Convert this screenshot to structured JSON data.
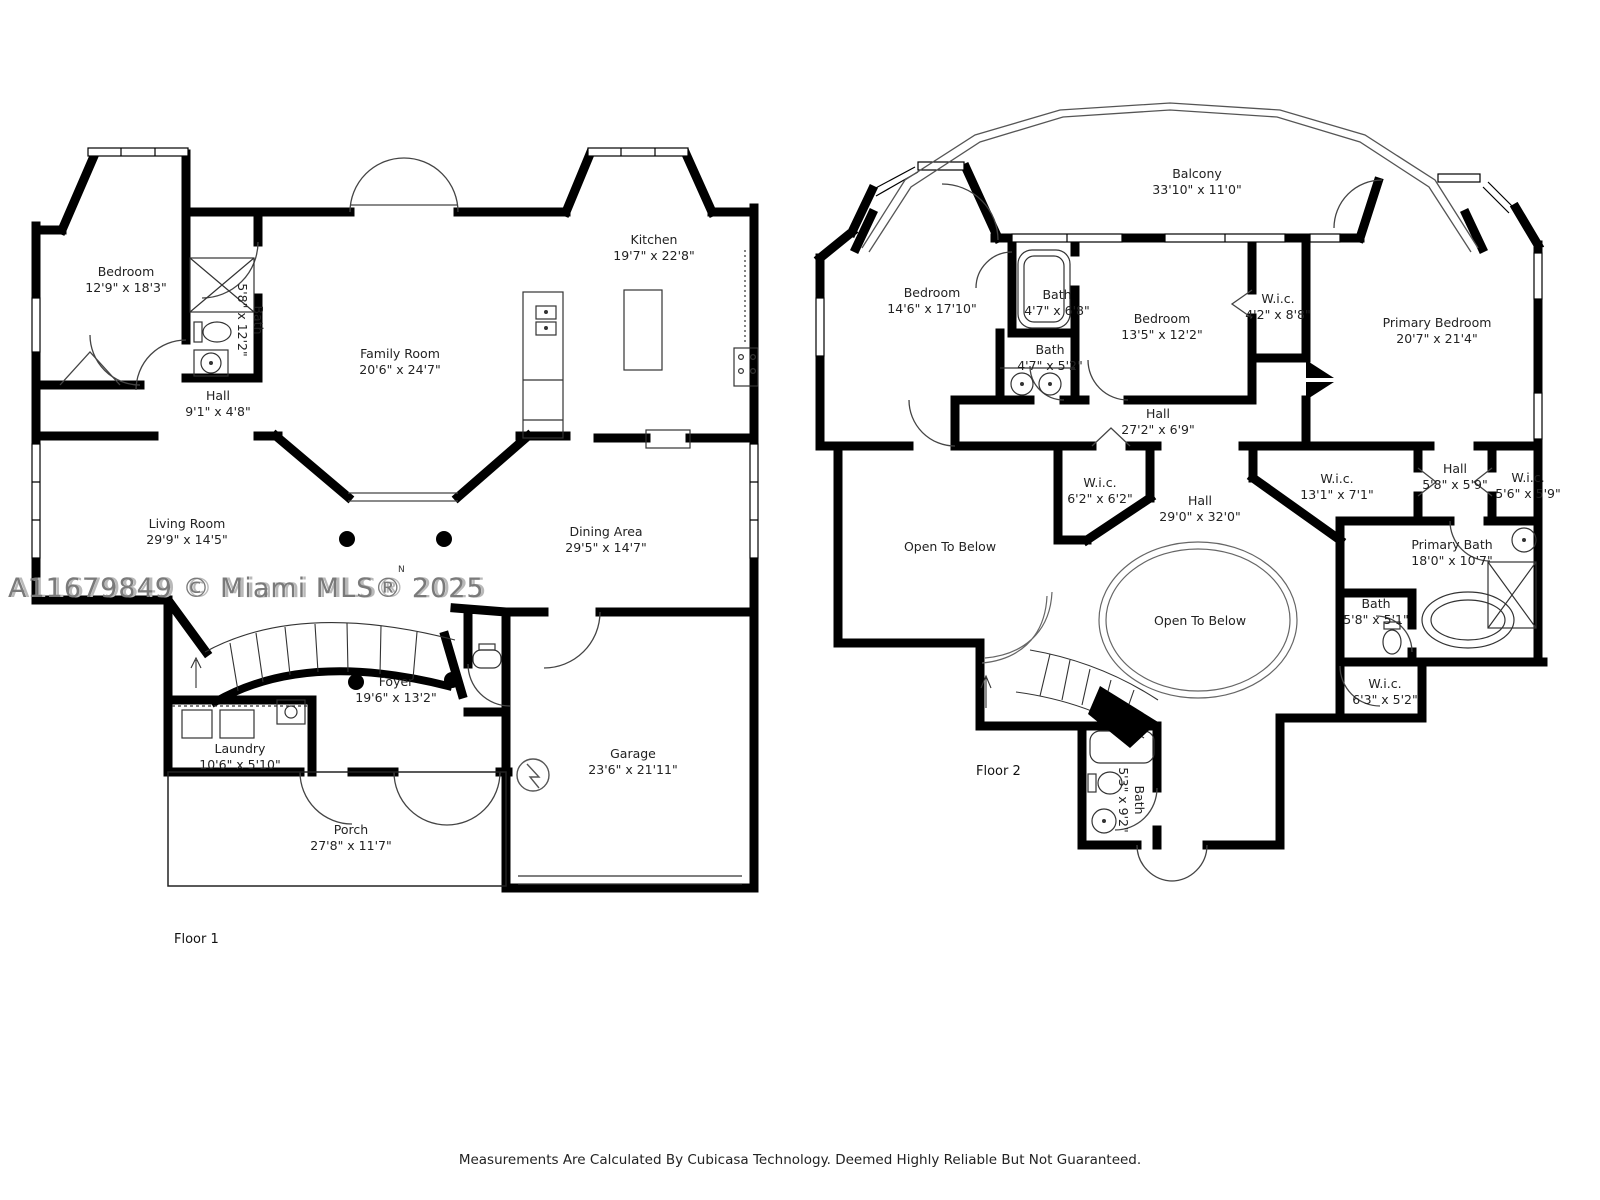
{
  "watermark": {
    "text": "A11679849 © Miami MLS® 2025"
  },
  "footer": {
    "text": "Measurements Are Calculated By Cubicasa Technology. Deemed Highly Reliable But Not Guaranteed."
  },
  "north_marker": "N",
  "floor1": {
    "label": "Floor 1",
    "rooms": [
      {
        "name": "Bedroom",
        "dims": "12'9\" x 18'3\""
      },
      {
        "name": "Bath",
        "dims": "5'8\" x 12'2\""
      },
      {
        "name": "Hall",
        "dims": "9'1\" x 4'8\""
      },
      {
        "name": "Family Room",
        "dims": "20'6\" x 24'7\""
      },
      {
        "name": "Kitchen",
        "dims": "19'7\" x 22'8\""
      },
      {
        "name": "Living Room",
        "dims": "29'9\" x 14'5\""
      },
      {
        "name": "Dining Area",
        "dims": "29'5\" x 14'7\""
      },
      {
        "name": "Foyer",
        "dims": "19'6\" x 13'2\""
      },
      {
        "name": "Laundry",
        "dims": "10'6\" x 5'10\""
      },
      {
        "name": "Garage",
        "dims": "23'6\" x 21'11\""
      },
      {
        "name": "Porch",
        "dims": "27'8\" x 11'7\""
      }
    ]
  },
  "floor2": {
    "label": "Floor 2",
    "rooms": [
      {
        "name": "Balcony",
        "dims": "33'10\" x 11'0\""
      },
      {
        "name": "Bedroom",
        "dims": "14'6\" x 17'10\""
      },
      {
        "name": "Bath",
        "dims": "4'7\" x 6'8\""
      },
      {
        "name": "Bath",
        "dims": "4'7\" x 5'2\""
      },
      {
        "name": "Bedroom",
        "dims": "13'5\" x 12'2\""
      },
      {
        "name": "W.i.c.",
        "dims": "4'2\" x 8'8\""
      },
      {
        "name": "Primary Bedroom",
        "dims": "20'7\" x 21'4\""
      },
      {
        "name": "Hall",
        "dims": "27'2\" x 6'9\""
      },
      {
        "name": "W.i.c.",
        "dims": "6'2\" x 6'2\""
      },
      {
        "name": "Hall",
        "dims": "29'0\" x 32'0\""
      },
      {
        "name": "W.i.c.",
        "dims": "13'1\" x 7'1\""
      },
      {
        "name": "Hall",
        "dims": "5'8\" x 5'9\""
      },
      {
        "name": "W.i.c.",
        "dims": "5'6\" x 5'9\""
      },
      {
        "name": "Open To Below",
        "dims": ""
      },
      {
        "name": "Primary Bath",
        "dims": "18'0\" x 10'7\""
      },
      {
        "name": "Bath",
        "dims": "5'8\" x 5'1\""
      },
      {
        "name": "Open To Below",
        "dims": ""
      },
      {
        "name": "W.i.c.",
        "dims": "6'3\" x 5'2\""
      },
      {
        "name": "Bath",
        "dims": "5'3\" x 9'2\""
      }
    ]
  }
}
